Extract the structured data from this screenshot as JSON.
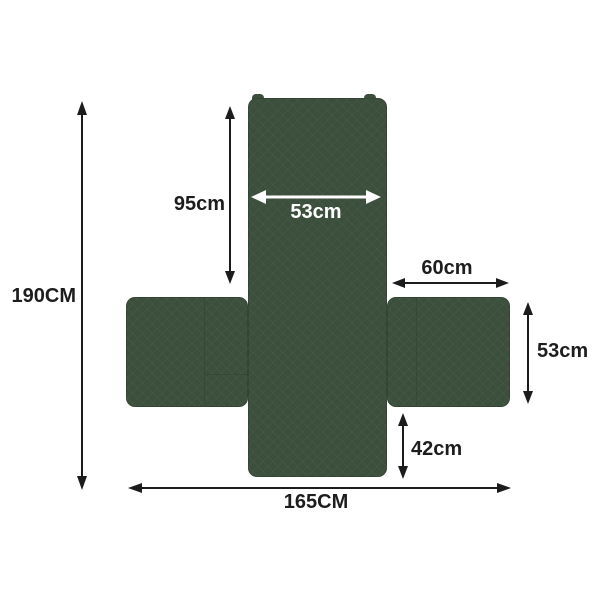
{
  "diagram": {
    "kind": "sofa-cover-dimension-diagram",
    "cover_color": "#3c4e3c",
    "arrow_color": "#1c1c1c",
    "inner_arrow_color": "#ffffff",
    "background_color": "#ffffff"
  },
  "dimensions": [
    {
      "id": "total-height",
      "label": "190CM",
      "orientation": "vertical",
      "placement": "left-outside"
    },
    {
      "id": "back-height",
      "label": "95cm",
      "orientation": "vertical",
      "placement": "beside-back-panel"
    },
    {
      "id": "back-width",
      "label": "53cm",
      "orientation": "horizontal",
      "placement": "inside-back-panel"
    },
    {
      "id": "right-arm-length",
      "label": "60cm",
      "orientation": "horizontal",
      "placement": "above-right-arm"
    },
    {
      "id": "right-arm-height",
      "label": "53cm",
      "orientation": "vertical",
      "placement": "right-of-right-arm"
    },
    {
      "id": "front-drop",
      "label": "42cm",
      "orientation": "vertical",
      "placement": "below-right-arm"
    },
    {
      "id": "total-width",
      "label": "165CM",
      "orientation": "horizontal",
      "placement": "bottom-outside"
    }
  ]
}
